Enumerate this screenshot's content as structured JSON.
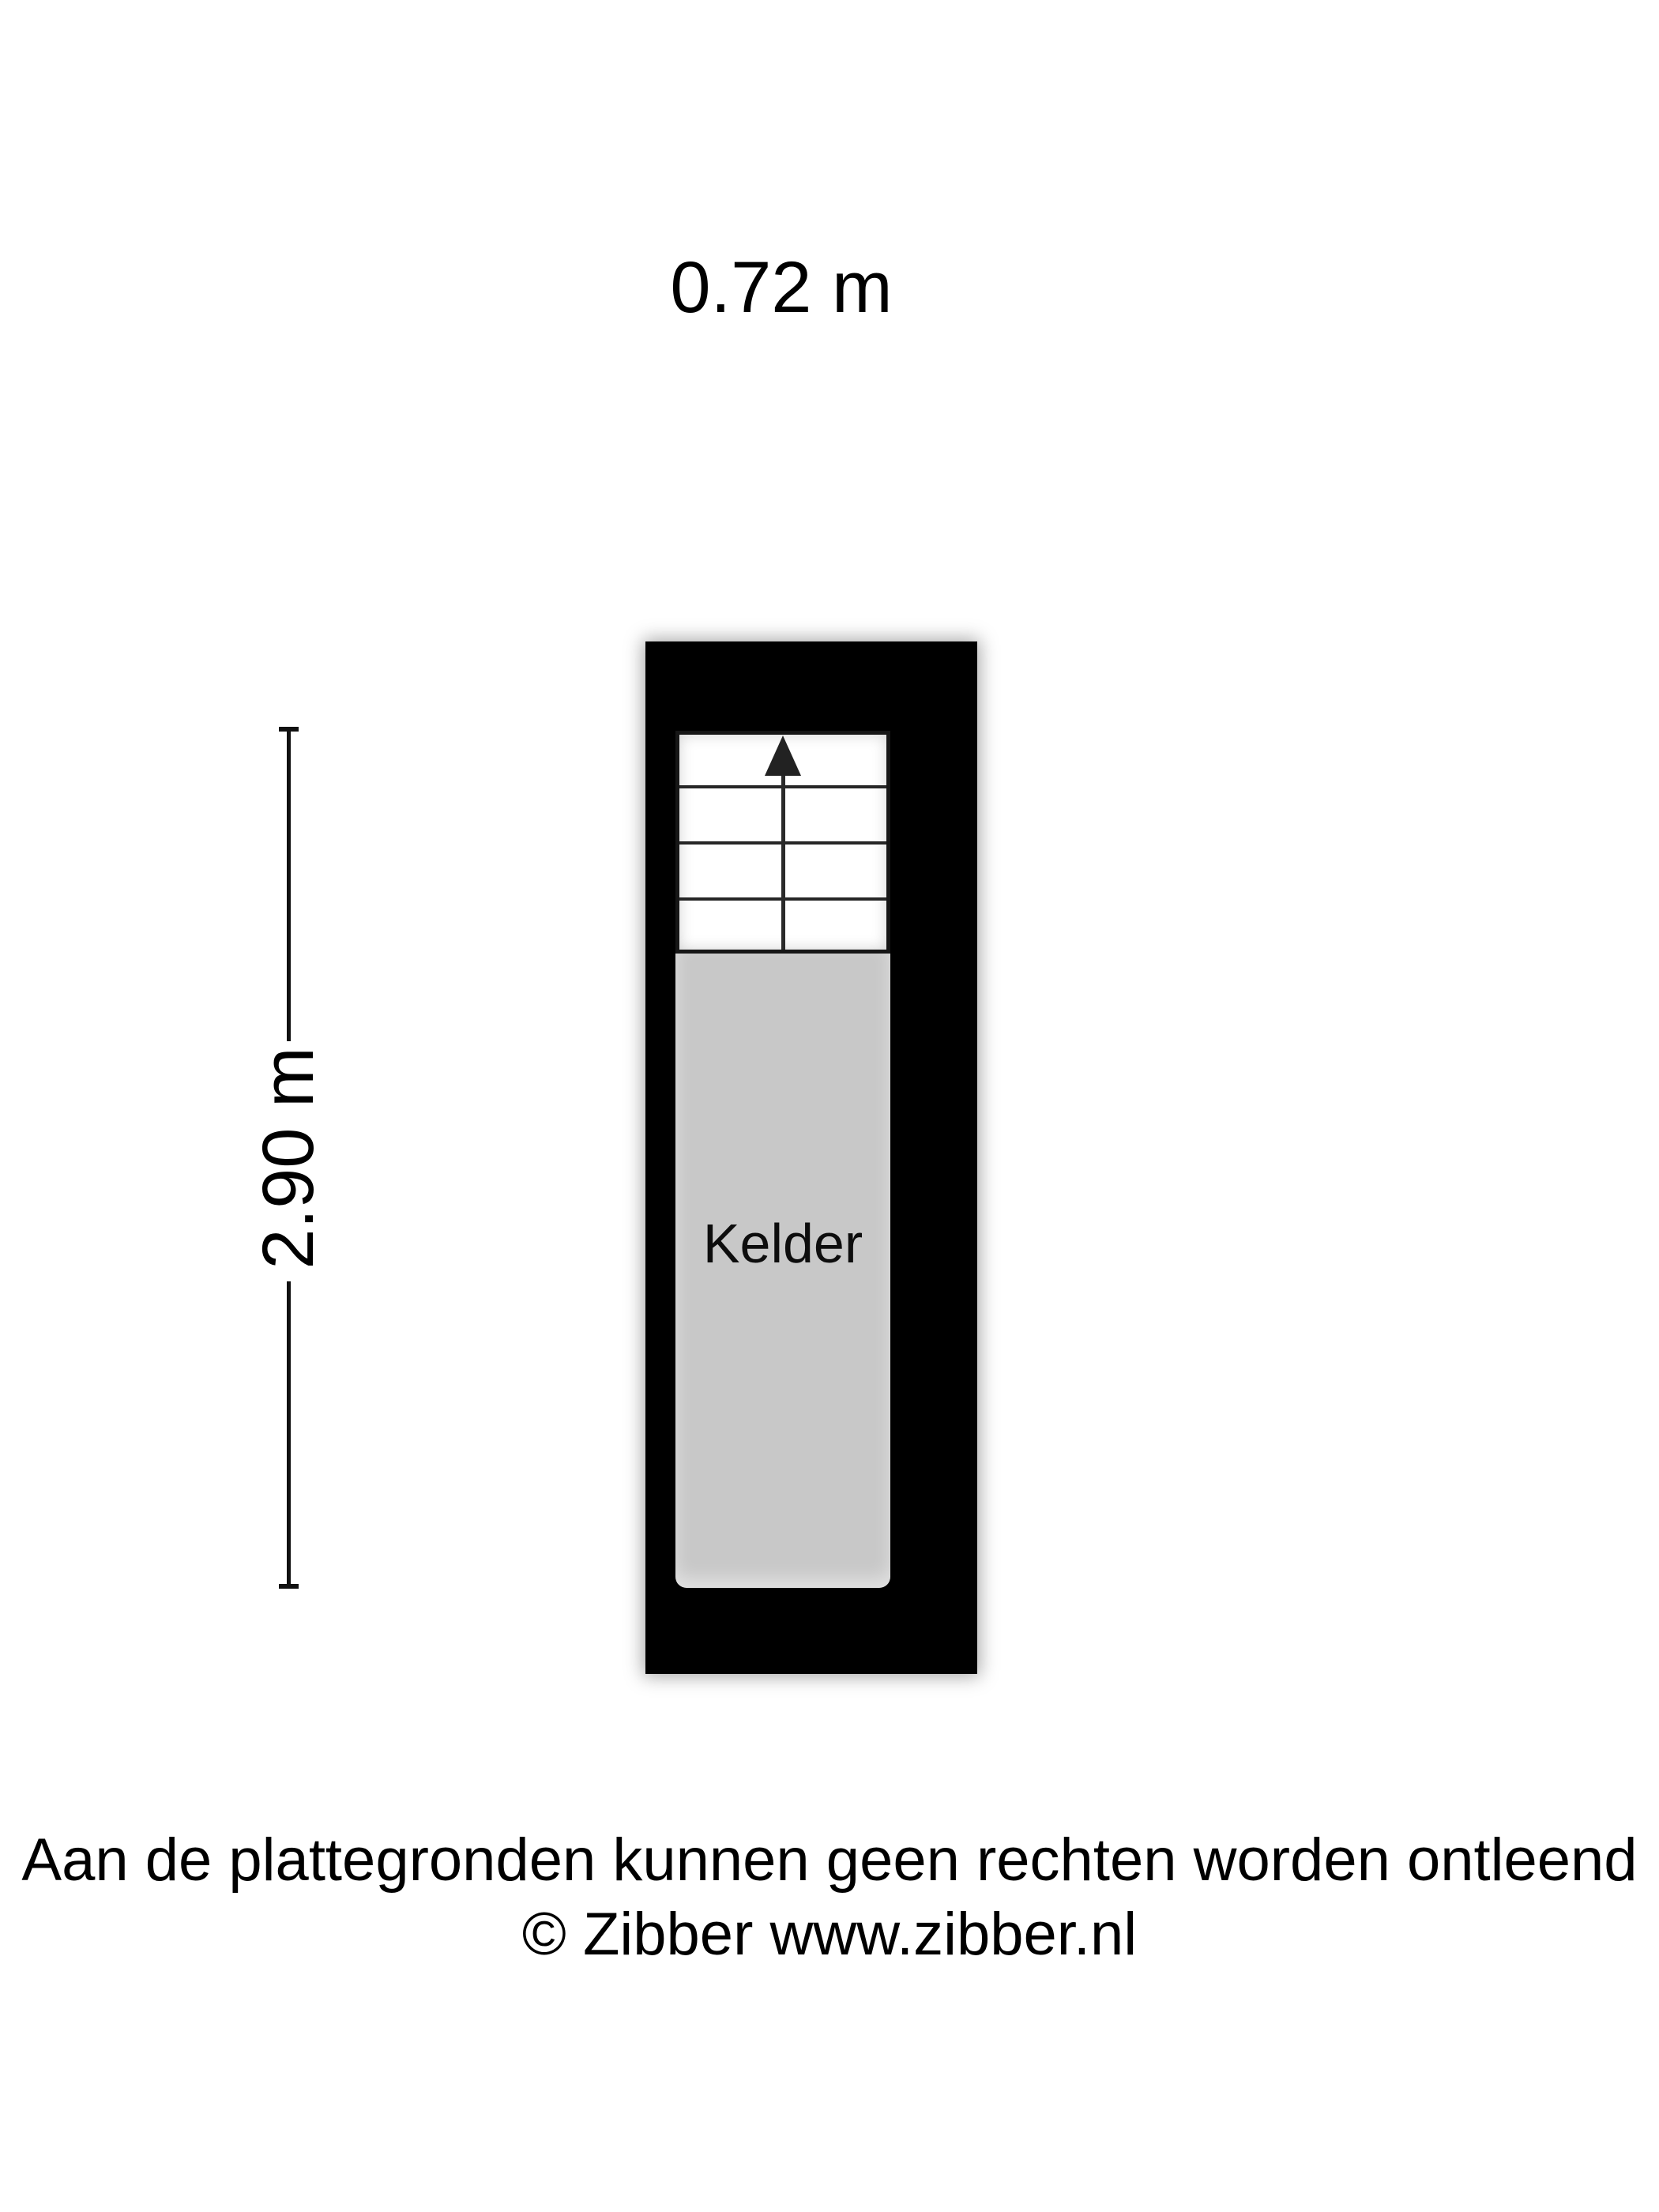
{
  "dimensions": {
    "width_label": "0.72 m",
    "height_label": "2.90 m"
  },
  "plan": {
    "room_label": "Kelder",
    "stair_treads": 4,
    "stair_direction_icon": "up-arrow",
    "wall_color": "#000000",
    "floor_color": "#c8c8c8",
    "stair_line_color": "#262626"
  },
  "footer": {
    "line1": "Aan de plattegronden kunnen geen rechten worden ontleend",
    "line2": "© Zibber www.zibber.nl"
  }
}
